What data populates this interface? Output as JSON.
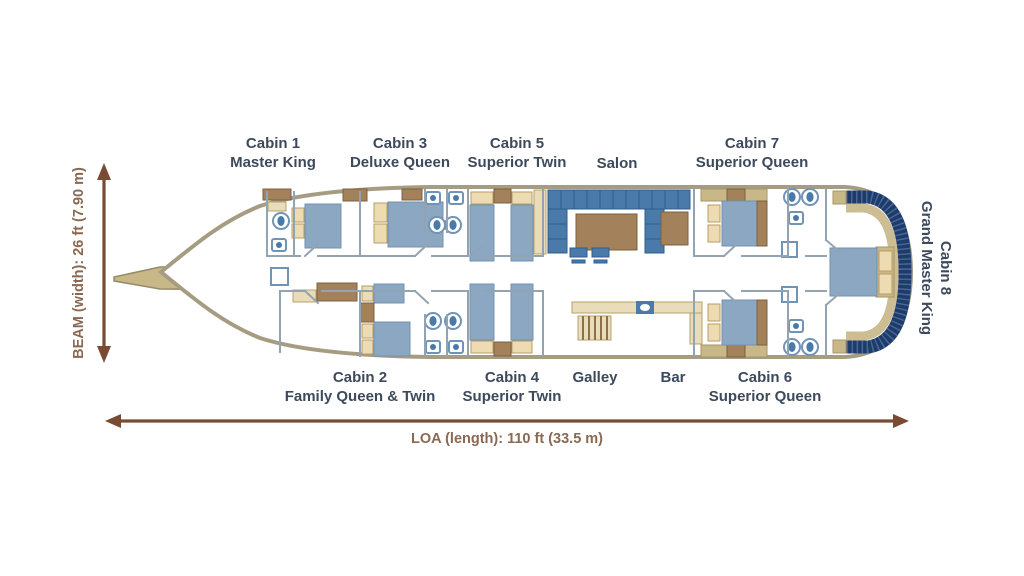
{
  "diagram_type": "yacht-deck-plan",
  "labels": {
    "top": [
      {
        "line1": "Cabin 1",
        "line2": "Master King"
      },
      {
        "line1": "Cabin 3",
        "line2": "Deluxe Queen"
      },
      {
        "line1": "Cabin 5",
        "line2": "Superior Twin"
      },
      {
        "line1": "Salon"
      },
      {
        "line1": "Cabin 7",
        "line2": "Superior Queen"
      }
    ],
    "bottom": [
      {
        "line1": "Cabin 2",
        "line2": "Family Queen & Twin"
      },
      {
        "line1": "Cabin 4",
        "line2": "Superior Twin"
      },
      {
        "line1": "Galley"
      },
      {
        "line1": "Bar"
      },
      {
        "line1": "Cabin 6",
        "line2": "Superior Queen"
      }
    ],
    "stern": {
      "line1": "Cabin 8",
      "line2": "Grand Master King"
    }
  },
  "dimensions": {
    "beam": "BEAM (width): 26 ft (7.90 m)",
    "loa": "LOA (length): 110 ft (33.5 m)"
  },
  "colors": {
    "label_text": "#3d4a5c",
    "dimension_text": "#8a6952",
    "arrow": "#7a4b33",
    "hull_outline": "#a59c82",
    "deck_tan": "#c9b887",
    "bed_blue": "#8ca7c2",
    "pillow_cream": "#eddcb2",
    "wood_brown": "#a3815a",
    "counter_tan": "#e9dcba",
    "sofa_blue": "#4a7aa9",
    "bench_navy": "#1f3c69"
  }
}
